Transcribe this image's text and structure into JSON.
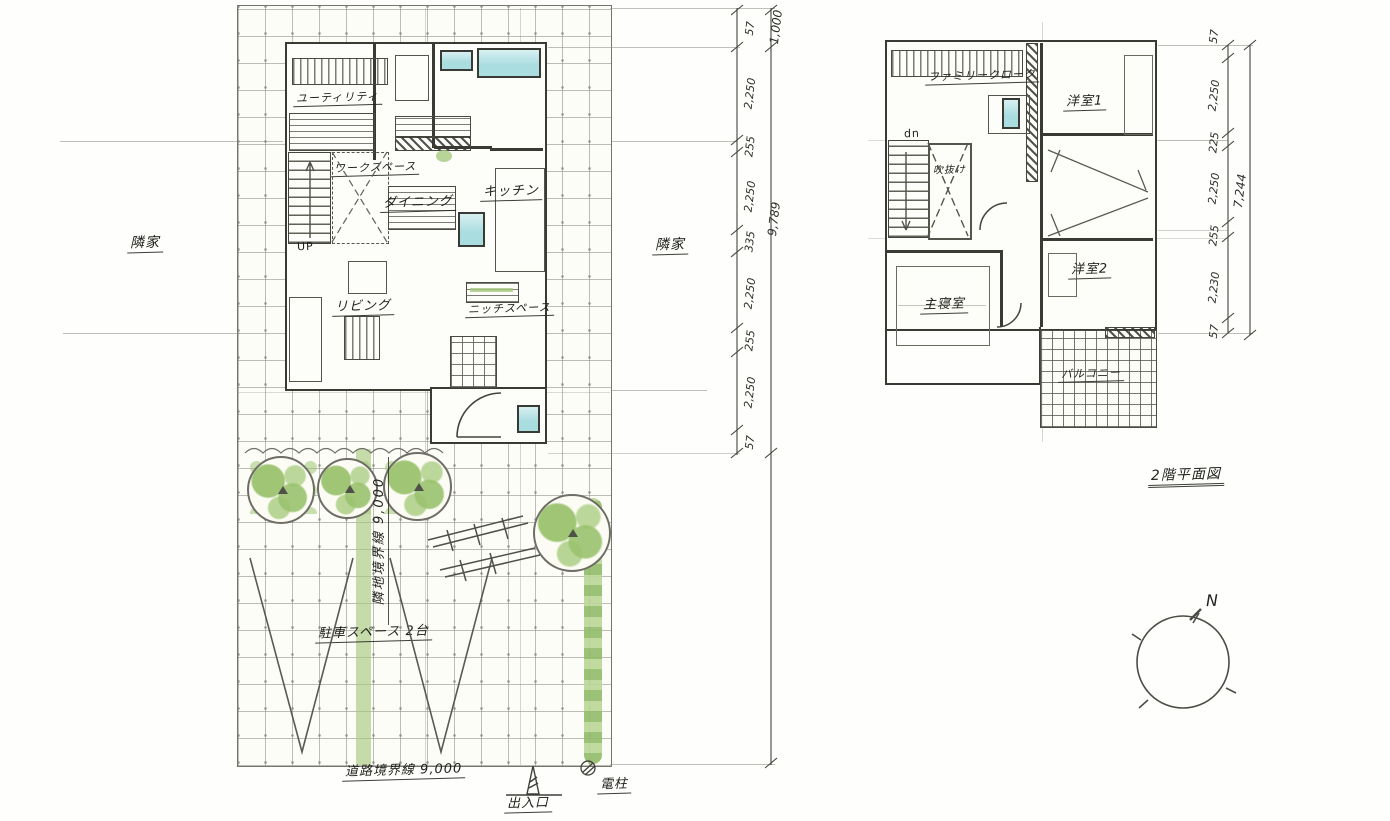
{
  "colors": {
    "paper": "#fefefc",
    "pencil": "#4a4a42",
    "wall": "#3a3a34",
    "window_teal": "#a9dde0",
    "plant_green": "#a4c87c"
  },
  "site": {
    "neighbor_left": "隣家",
    "neighbor_right": "隣家",
    "side_boundary": "隣地境界線 9,000",
    "road_boundary": "道路境界線 9,000",
    "parking": "駐車スペース 2台",
    "gate": "出入口",
    "pole": "電柱"
  },
  "floor1": {
    "utility": "ユーティリティ",
    "workspace": "ワークスペース",
    "dining": "ダイニング",
    "kitchen": "キッチン",
    "living": "リビング",
    "niche": "ニッチスペース",
    "up": "UP"
  },
  "floor2": {
    "title": "2階平面図",
    "family_closet": "ファミリークローク",
    "bedroom1": "洋室1",
    "void": "吹抜け",
    "master": "主寝室",
    "bedroom2": "洋室2",
    "balcony": "バルコニー",
    "down": "dn"
  },
  "dims": {
    "site_chain": [
      "57",
      "2,250",
      "255",
      "2,250",
      "335",
      "2,250",
      "255",
      "2,250",
      "57"
    ],
    "site_setback": "1,000",
    "site_total": "9,789",
    "floor2_chain": [
      "57",
      "2,250",
      "225",
      "2,250",
      "255",
      "2,230",
      "57"
    ],
    "floor2_total": "7,244"
  },
  "compass": {
    "north": "N"
  }
}
